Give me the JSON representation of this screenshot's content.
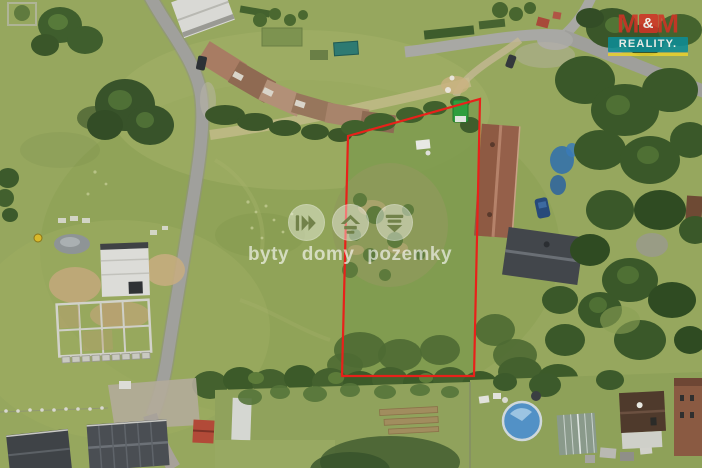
{
  "photo": {
    "type": "aerial-drone-photograph",
    "subject": "grass building plot outlined in red, surrounded by meadows, country roads, farm buildings with rusty roofs, family houses, gardens, a pool and trees"
  },
  "plot_overlay": {
    "boundary_color": "#e8211a"
  },
  "watermark": {
    "text": "byty domy pozemky",
    "icons": [
      {
        "name": "apartments-icon"
      },
      {
        "name": "house-icon"
      },
      {
        "name": "land-icon"
      }
    ],
    "color": "#ffffff"
  },
  "logo": {
    "brand": "M&M Reality",
    "m_left": "M",
    "ampersand": "&",
    "m_right": "M",
    "reality_label": "REALITY.",
    "colors": {
      "red": "#d03326",
      "teal": "#0d8c96",
      "yellow": "#e8d12f"
    }
  }
}
